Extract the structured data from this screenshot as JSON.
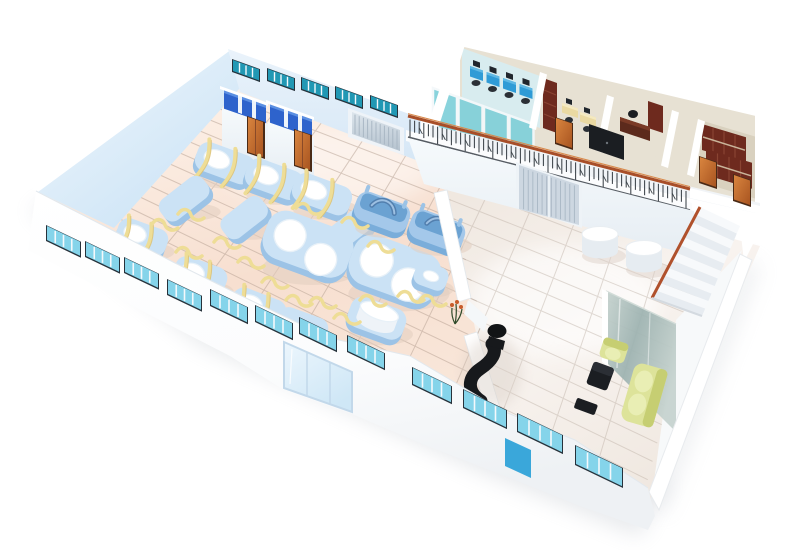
{
  "meta": {
    "title": "3D isometric factory and office floor plan illustration",
    "description": "Cut-away aerial rendering of an industrial facility: production hall with rows of light-blue machines strapped with yellow bands, changing-room stalls, a loading roller door, a mezzanine office wing (computer office, staff office, manager office, archive room), ornamental railing, staircase, ground-floor lobby with round tables, and a reception lounge with black desk and yellow-green sofa set."
  },
  "palette": {
    "bg": "#ffffff",
    "shadow": "#c9ced4",
    "floorFactoryA": "#fdf2e9",
    "floorFactoryB": "#f7dfd0",
    "floorFactoryC": "#f9e7da",
    "floorHallA": "#efe7df",
    "floorHallB": "#f8f3ef",
    "gridFactory": "#b39e90",
    "gridHall": "#bdb0a5",
    "wallBlueA": "#f0f7fd",
    "wallBlueB": "#c9e2f5",
    "wallFaceA": "#eaf3fb",
    "wallFaceB": "#d6e7f6",
    "wallWhite": "#ffffff",
    "wallShade": "#eef2f6",
    "windowPane": "#85d4ea",
    "windowPaneDark": "#2198b4",
    "windowFrame": "#27323b",
    "mullion": "#f4f8fb",
    "stallBlue": "#2e63cc",
    "stallBlueLight": "#5b8fe2",
    "doorOrange": "#d9853f",
    "doorOrangeDark": "#a85420",
    "doorFrame": "#4a2a16",
    "roller": "#ccd6e0",
    "rollerStripe": "#a9b7c4",
    "machineSide": "#9cc3e6",
    "machineTop": "#cbe2f5",
    "machineDark": "#7aadda",
    "machineDarkTop": "#a4c8ea",
    "machineShadow": "#e2cdbf",
    "lid": "#ffffff",
    "lidEdge": "#e8f1f8",
    "strap": "#eedd96",
    "strapDark": "#d9ba6a",
    "railTop": "#a84e28",
    "railHi": "#d98a4c",
    "baluster": "#3b4248",
    "railBottom": "#565c63",
    "glassOffice": "#7fd0da",
    "glassEdge": "#f4f8fa",
    "deskBlue": "#2f9bd6",
    "deskBlueTop": "#5fb8e4",
    "monitor": "#20262d",
    "chairDark": "#2b3036",
    "deskYellow": "#ead9a2",
    "deskYellowTop": "#f4e9c0",
    "woodDark": "#6e2a1e",
    "woodMid": "#8a4432",
    "roomPale": "#e7e1d3",
    "roomBlue": "#d8ecef",
    "roomTan": "#d9d1bf",
    "black": "#1b1e22",
    "blackTop": "#2b2f35",
    "sofaA": "#dde39a",
    "sofaB": "#c6ce72",
    "sofaC": "#e9eeb4",
    "glassWallA": "#9eb3b1",
    "glassWallB": "#c6d3cf",
    "stairRed": "#b0512c",
    "stepA": "#f7f9fb",
    "stepB": "#e7ecf1",
    "slidingDoor": "#cdd7e1",
    "doorSeam": "#f2f6fa",
    "bluePanel": "#3aa7da",
    "glassDoorA": "#ecf6fd",
    "glassDoorB": "#cfe7f6",
    "glassDoorFrame": "#c2d8ea",
    "cylWhite": "#ffffff",
    "cylSide": "#e6ecf1",
    "corridorFloor": "#f1f4f7",
    "plantOrange": "#c75b2a",
    "plantGreen": "#2f4a2a"
  },
  "scene": {
    "factory_hall": {
      "label": "production hall",
      "machines_with_lid": 6,
      "machines_plain": 4,
      "machines_double_lid": 2,
      "machines_with_handle": 2,
      "drum_machines": 1,
      "small_machines": 1,
      "yellow_straps": "bands over machines and loose ribbons on floor",
      "back_window_strips": 5,
      "panes_per_strip": 4
    },
    "changing_rooms": {
      "label": "changing-room blocks",
      "blocks": 2,
      "stalls_per_block": 3,
      "orange_doors": 2
    },
    "loading_door": {
      "label": "roller shutter door",
      "count": 1
    },
    "office_wing": {
      "label": "mezzanine office wing",
      "rooms": [
        {
          "name": "computer office",
          "workstations": 4,
          "glass_panels": 4
        },
        {
          "name": "staff office",
          "desks": 2,
          "bookshelf": 1
        },
        {
          "name": "manager office",
          "desk": 1,
          "cabinet": 1
        },
        {
          "name": "storage room"
        },
        {
          "name": "archive room",
          "bookshelves": 2
        }
      ],
      "corridor_orange_doors": 3,
      "display_board": 1,
      "railing": "wrought-iron balusters with red-brown top rail"
    },
    "ground_hall": {
      "label": "ground lobby",
      "sliding_door": 1,
      "round_tables": 2,
      "staircase_steps": 12
    },
    "reception": {
      "label": "reception lounge",
      "reception_desk": "black S-curved counter with chair",
      "cube_stool": 1,
      "side_mat": 1,
      "armchair": 1,
      "sofa": 1,
      "glass_partition": 1,
      "wall_plant": 1
    },
    "front_wall": {
      "window_strips": 12,
      "panes_per_strip": 4,
      "entrance_glass_door_panels": 3,
      "blue_panel": 1
    }
  }
}
